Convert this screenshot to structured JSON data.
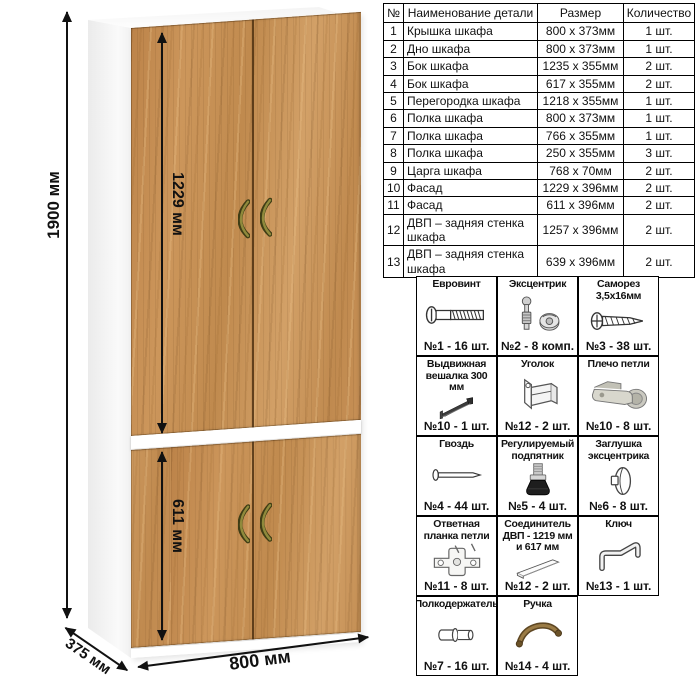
{
  "drawing": {
    "dimensions": {
      "height": "1900 мм",
      "upper_section_height": "1229 мм",
      "lower_section_height": "611 мм",
      "width": "800 мм",
      "depth": "375 мм"
    },
    "colors": {
      "wood": "#c68f55",
      "carcass": "#ffffff",
      "handle": "#8f8a3c",
      "dimension_lines": "#111111"
    }
  },
  "parts_table": {
    "headers": [
      "№",
      "Наименование детали",
      "Размер",
      "Количество"
    ],
    "rows": [
      [
        "1",
        "Крышка шкафа",
        "800 х 373мм",
        "1 шт."
      ],
      [
        "2",
        "Дно шкафа",
        "800 х 373мм",
        "1 шт."
      ],
      [
        "3",
        "Бок шкафа",
        "1235 х 355мм",
        "2 шт."
      ],
      [
        "4",
        "Бок шкафа",
        "617 х 355мм",
        "2 шт."
      ],
      [
        "5",
        "Перегородка шкафа",
        "1218 х 355мм",
        "1 шт."
      ],
      [
        "6",
        "Полка шкафа",
        "800 х 373мм",
        "1 шт."
      ],
      [
        "7",
        "Полка шкафа",
        "766 х 355мм",
        "1 шт."
      ],
      [
        "8",
        "Полка шкафа",
        "250 х 355мм",
        "3 шт."
      ],
      [
        "9",
        "Царга шкафа",
        "768 х 70мм",
        "2 шт."
      ],
      [
        "10",
        "Фасад",
        "1229 х 396мм",
        "2 шт."
      ],
      [
        "11",
        "Фасад",
        "611 х 396мм",
        "2 шт."
      ],
      [
        "12",
        "ДВП – задняя стенка шкафа",
        "1257 х 396мм",
        "2 шт."
      ],
      [
        "13",
        "ДВП – задняя стенка шкафа",
        "639 х 396мм",
        "2 шт."
      ]
    ]
  },
  "hardware": {
    "items": [
      {
        "title": "Евровинт",
        "count": "№1 - 16 шт.",
        "icon": "euro-screw-icon"
      },
      {
        "title": "Эксцентрик",
        "count": "№2 - 8 комп.",
        "icon": "eccentric-cam-icon"
      },
      {
        "title": "Саморез 3,5х16мм",
        "count": "№3 - 38 шт.",
        "icon": "self-tapping-screw-icon"
      },
      {
        "title": "Выдвижная вешалка 300 мм",
        "count": "№10 - 1 шт.",
        "icon": "pullout-hanger-icon"
      },
      {
        "title": "Уголок",
        "count": "№12 - 2 шт.",
        "icon": "corner-bracket-icon"
      },
      {
        "title": "Плечо петли",
        "count": "№10 - 8 шт.",
        "icon": "hinge-arm-icon"
      },
      {
        "title": "Гвоздь",
        "count": "№4 - 44 шт.",
        "icon": "nail-icon"
      },
      {
        "title": "Регулируемый подпятник",
        "count": "№5 - 4 шт.",
        "icon": "adjustable-foot-icon"
      },
      {
        "title": "Заглушка эксцентрика",
        "count": "№6 - 8 шт.",
        "icon": "cam-cap-icon"
      },
      {
        "title": "Ответная планка петли",
        "count": "№11 - 8 шт.",
        "icon": "hinge-plate-icon"
      },
      {
        "title": "Соединитель ДВП - 1219 мм и 617 мм",
        "count": "№12 - 2 шт.",
        "icon": "hdf-connector-icon"
      },
      {
        "title": "Ключ",
        "count": "№13 - 1 шт.",
        "icon": "key-icon"
      },
      {
        "title": "Полкодержатель",
        "count": "№7 - 16 шт.",
        "icon": "shelf-pin-icon"
      },
      {
        "title": "Ручка",
        "count": "№14 - 4 шт.",
        "icon": "handle-icon"
      }
    ]
  }
}
